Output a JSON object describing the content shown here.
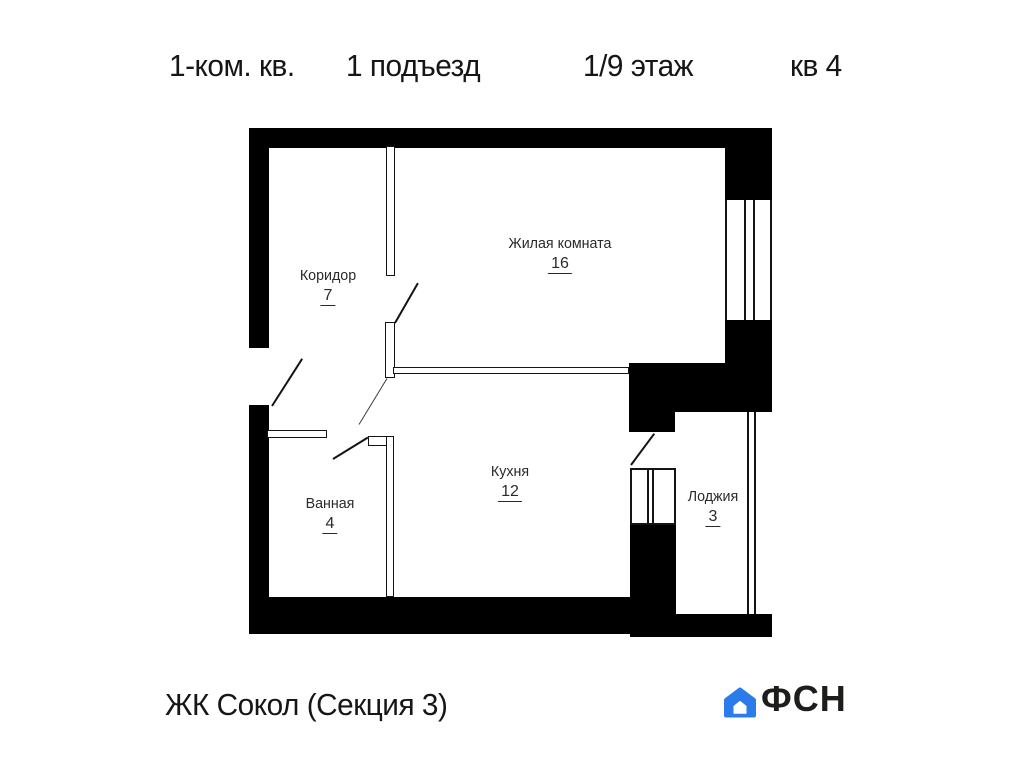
{
  "header": {
    "apartment_type": "1-ком. кв.",
    "entrance": "1 подъезд",
    "floor": "1/9 этаж",
    "apartment_number": "кв 4"
  },
  "rooms": [
    {
      "name": "Жилая комната",
      "area": "16"
    },
    {
      "name": "Коридор",
      "area": "7"
    },
    {
      "name": "Ванная",
      "area": "4"
    },
    {
      "name": "Кухня",
      "area": "12"
    },
    {
      "name": "Лоджия",
      "area": "3"
    }
  ],
  "footer": {
    "complex_name": "ЖК Сокол (Секция 3)",
    "logo_text": "ФСН",
    "logo_color": "#2b7cea",
    "house_icon": "house-icon"
  },
  "colors": {
    "wall": "#000000",
    "background": "#ffffff",
    "accent_blue": "#2b7cea"
  }
}
